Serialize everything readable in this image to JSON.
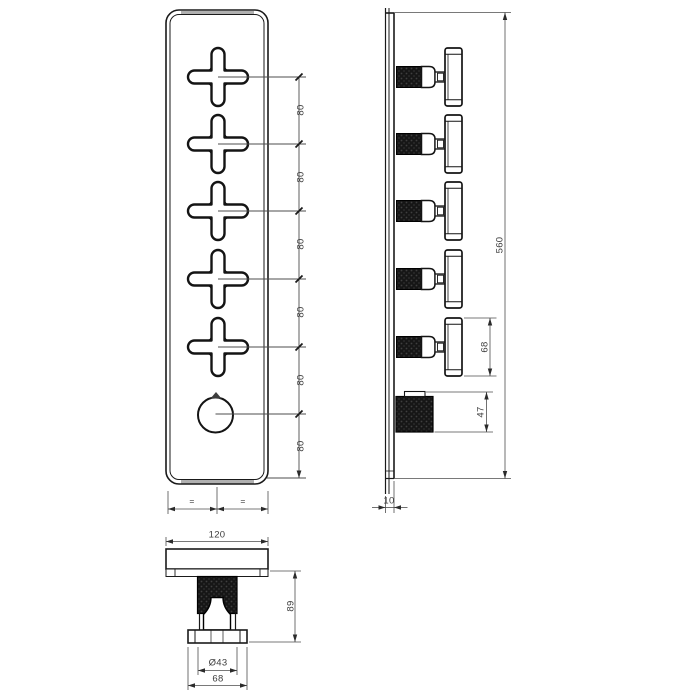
{
  "drawing": {
    "title": "shower-mixer-technical-drawing",
    "front_view": {
      "spacing_labels": [
        "80",
        "80",
        "80",
        "80",
        "80",
        "80"
      ],
      "equal_labels": [
        "=",
        "="
      ]
    },
    "side_view": {
      "overall_height": "560",
      "handle_length": "68",
      "knob_projection": "47",
      "plate_thickness": "10"
    },
    "bottom_view": {
      "plate_width": "120",
      "knurl_diameter": "Ø43",
      "handle_width": "68",
      "projection": "89"
    },
    "colors": {
      "line": "#1a1a1a",
      "dimension": "#4d4d4d",
      "knurl_fill": "#161616",
      "edge_band": "#b0b0b0"
    }
  }
}
